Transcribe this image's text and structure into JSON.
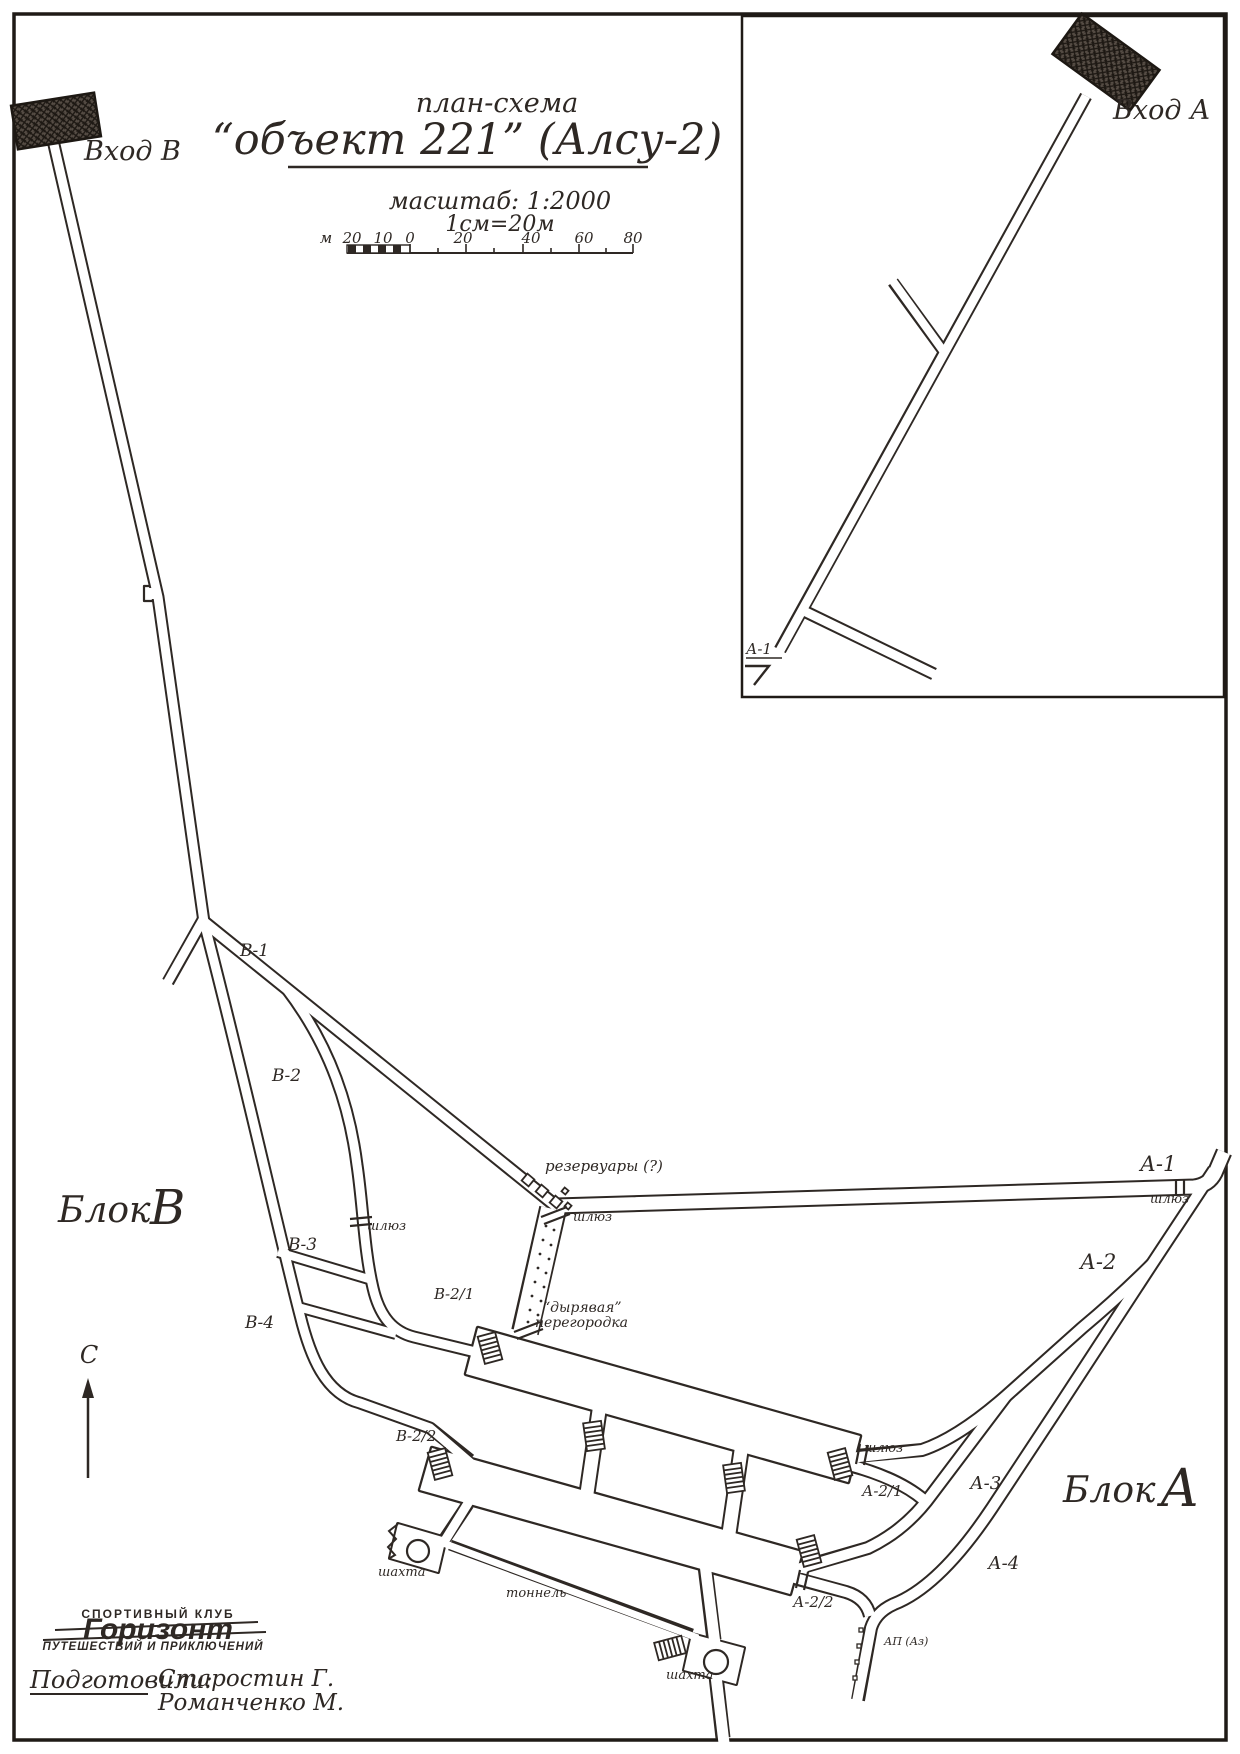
{
  "title": {
    "subtitle": "план-схема",
    "main": "“объект 221” (Алсу-2)",
    "scale_line1": "масштаб: 1:2000",
    "scale_line2": "1см=20м"
  },
  "scale_bar": {
    "unit": "м",
    "t_m20": "20",
    "t_m10": "10",
    "t_0": "0",
    "t_20": "20",
    "t_40": "40",
    "t_60": "60",
    "t_80": "80"
  },
  "entrances": {
    "b": "Вход В",
    "a": "Вход А"
  },
  "blocks": {
    "word_b": "Блок",
    "letter_b": "В",
    "word_a": "Блок",
    "letter_a": "А"
  },
  "labels": {
    "v1": "В-1",
    "v2": "В-2",
    "v3": "В-3",
    "v4": "В-4",
    "v21": "В-2/1",
    "v22": "В-2/2",
    "a1_inset": "А-1",
    "a1": "А-1",
    "a2": "А-2",
    "a3": "А-3",
    "a4": "А-4",
    "a21": "А-2/1",
    "a22": "А-2/2",
    "reservoirs": "резервуары (?)",
    "shluz": "шлюз",
    "partition_line1": "“дырявая”",
    "partition_line2": "перегородка",
    "shaft": "шахта",
    "tunnel": "тоннель",
    "ap": "АП (Аз)",
    "north": "С"
  },
  "logo": {
    "top": "СПОРТИВНЫЙ КЛУБ",
    "name": "Горизонт",
    "bottom": "ПУТЕШЕСТВИЙ И ПРИКЛЮЧЕНИЙ"
  },
  "credits": {
    "prepared_by": "Подготовили:",
    "name1": "Старостин Г.",
    "name2": "Романченко М."
  },
  "colors": {
    "ink": "#2e2824",
    "paper": "#ffffff"
  }
}
